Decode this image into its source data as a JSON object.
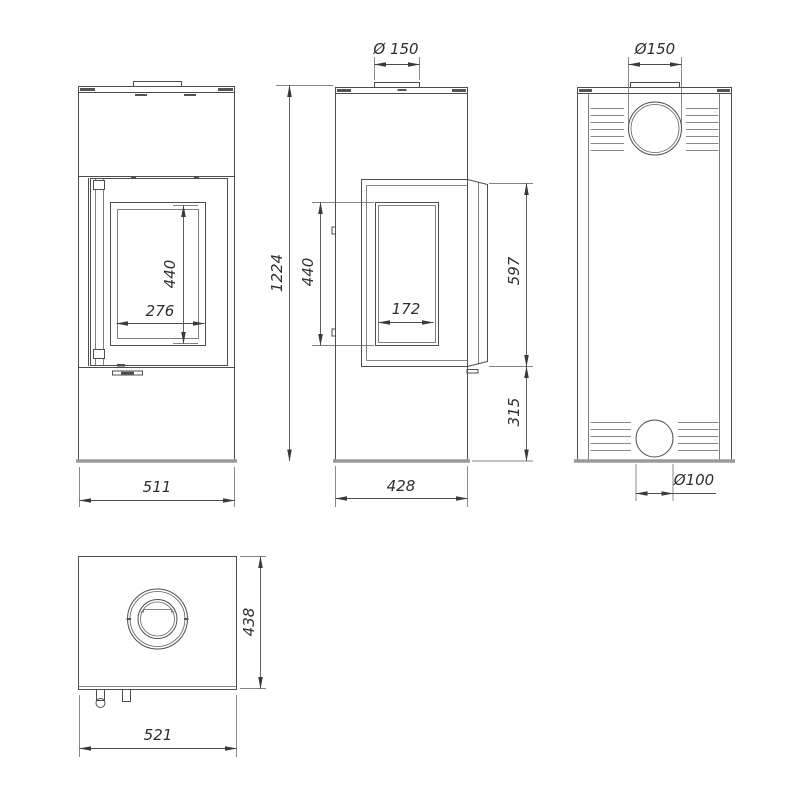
{
  "colors": {
    "background": "#ffffff",
    "line": "#4d4d4d",
    "base_plate": "#9a9a9a",
    "text": "#2e2e2e"
  },
  "views": {
    "front": {
      "dims": {
        "glass_height": "440",
        "glass_width": "276",
        "overall_width": "511"
      }
    },
    "side": {
      "dims": {
        "flue_diameter": "Ø 150",
        "overall_height": "1224",
        "glass_height": "440",
        "glass_width": "172",
        "door_height": "597",
        "plinth_height": "315",
        "overall_depth": "428"
      }
    },
    "back": {
      "dims": {
        "flue_diameter": "Ø150",
        "air_inlet_diameter": "Ø100"
      }
    },
    "top": {
      "dims": {
        "overall_depth": "438",
        "overall_width": "521"
      }
    }
  }
}
